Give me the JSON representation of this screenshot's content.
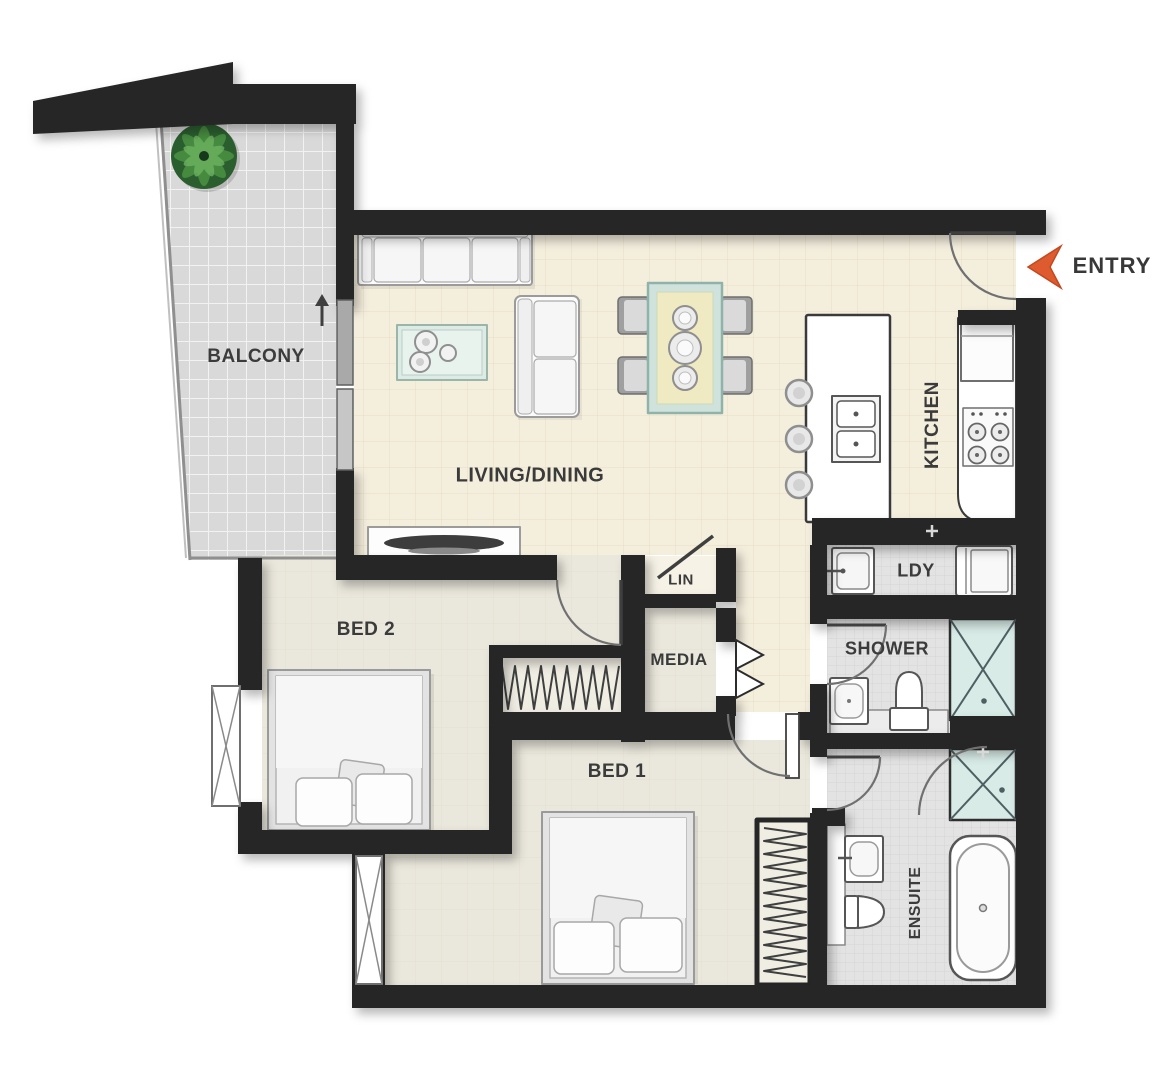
{
  "title": "2 bedroom apartment floor plan",
  "rooms": {
    "balcony": {
      "label": "BALCONY"
    },
    "living": {
      "label": "LIVING/DINING"
    },
    "kitchen": {
      "label": "KITCHEN"
    },
    "laundry": {
      "label": "LDY"
    },
    "linen": {
      "label": "LIN"
    },
    "media": {
      "label": "MEDIA"
    },
    "shower": {
      "label": "SHOWER"
    },
    "bed2": {
      "label": "BED 2"
    },
    "bed1": {
      "label": "BED 1"
    },
    "ensuite": {
      "label": "ENSUITE"
    }
  },
  "entry": {
    "label": "ENTRY"
  },
  "icons": {
    "entry_arrow": "left-chevron-arrow",
    "north_arrow": "up-arrow",
    "plant": "potted-plant"
  },
  "colors": {
    "wall": "#262626",
    "entry_arrow": "#DD5B2E",
    "living_floor": "#f4eedd",
    "bedroom_floor": "#eae7dc",
    "wet_floor": "#e3e3e3",
    "balcony_floor": "#d9d9d9",
    "fixture_teal": "#d8ebe6",
    "plant_green": "#4a8f42",
    "label_text": "#3b3b3b"
  }
}
